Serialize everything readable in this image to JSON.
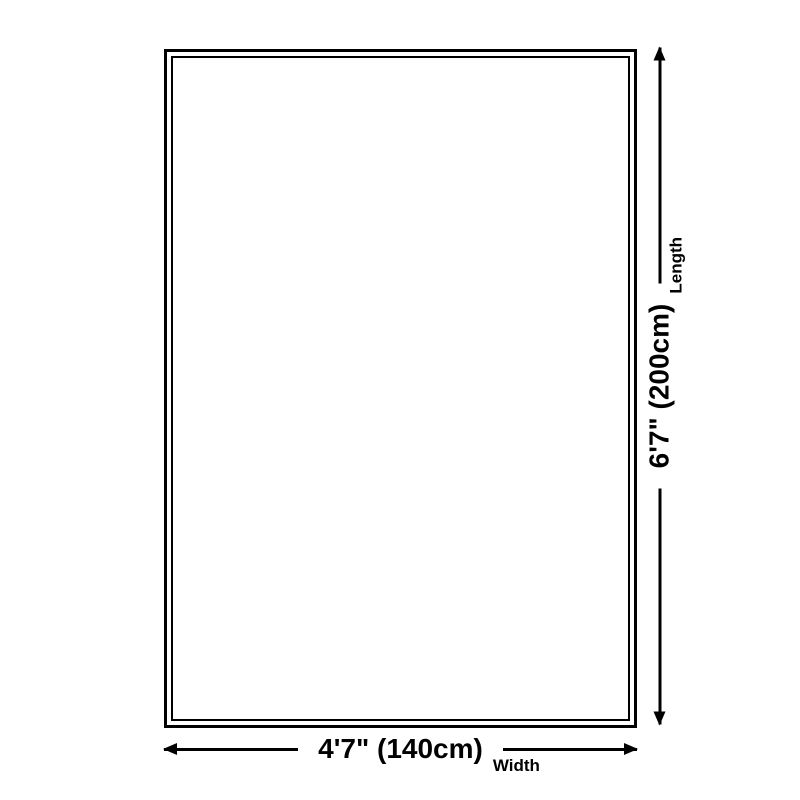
{
  "canvas": {
    "background": "#ffffff",
    "ink_color": "#000000"
  },
  "length_dimension": {
    "value": "6'7\" (200cm)",
    "label": "Length"
  },
  "width_dimension": {
    "value": "4'7\" (140cm)",
    "label": "Width"
  }
}
